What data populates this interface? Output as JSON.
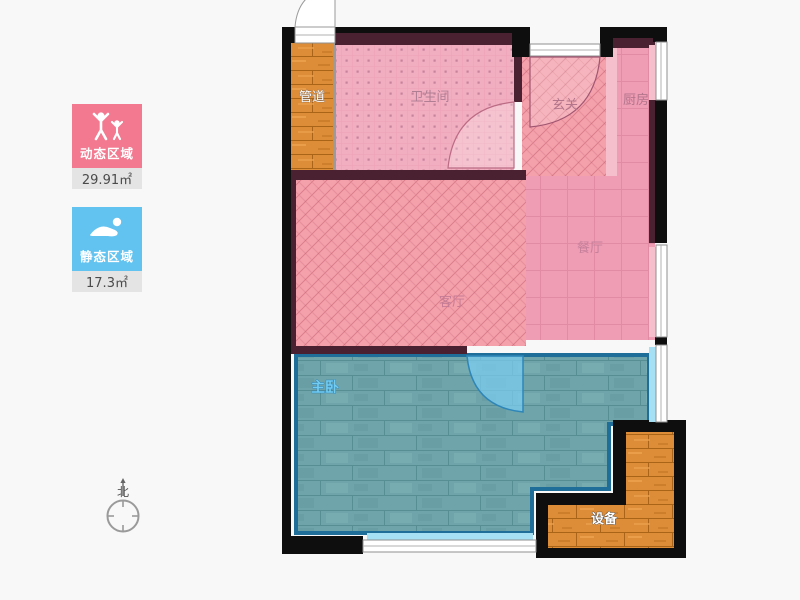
{
  "legend": {
    "dynamic_zone": {
      "label": "动态区域",
      "area": "29.91㎡",
      "color": "#f2798f",
      "icon": "people-arms-up-icon"
    },
    "static_zone": {
      "label": "静态区域",
      "area": "17.3㎡",
      "color": "#62c3f0",
      "icon": "swimmer-icon"
    }
  },
  "compass": {
    "north_label": "北"
  },
  "rooms": [
    {
      "id": "duct",
      "label": "管道"
    },
    {
      "id": "bathroom",
      "label": "卫生间"
    },
    {
      "id": "hallway",
      "label": "玄关"
    },
    {
      "id": "kitchen",
      "label": "厨房"
    },
    {
      "id": "dining",
      "label": "餐厅"
    },
    {
      "id": "living",
      "label": "客厅"
    },
    {
      "id": "master-bedroom",
      "label": "主卧"
    },
    {
      "id": "equipment",
      "label": "设备"
    }
  ],
  "colors": {
    "background": "#f8f8f8",
    "wall_exterior": "#0f0e0e",
    "wall_interior": "#4a2130",
    "room_pink_hatch": "#f4a1ac",
    "room_pink_dots": "#f2aec1",
    "room_pink_grid": "#ef9cb5",
    "wood_orange": "#dd8c37",
    "bedroom_teal": "#6fa5aa",
    "bedroom_border": "#1e6e99",
    "window_blue": "#a6e0f5",
    "window_pink": "#f6bfcc",
    "label_pink_text": "#b3758b",
    "bedroom_label": "#72ccf2",
    "value_strip_bg": "#e4e4e4"
  }
}
